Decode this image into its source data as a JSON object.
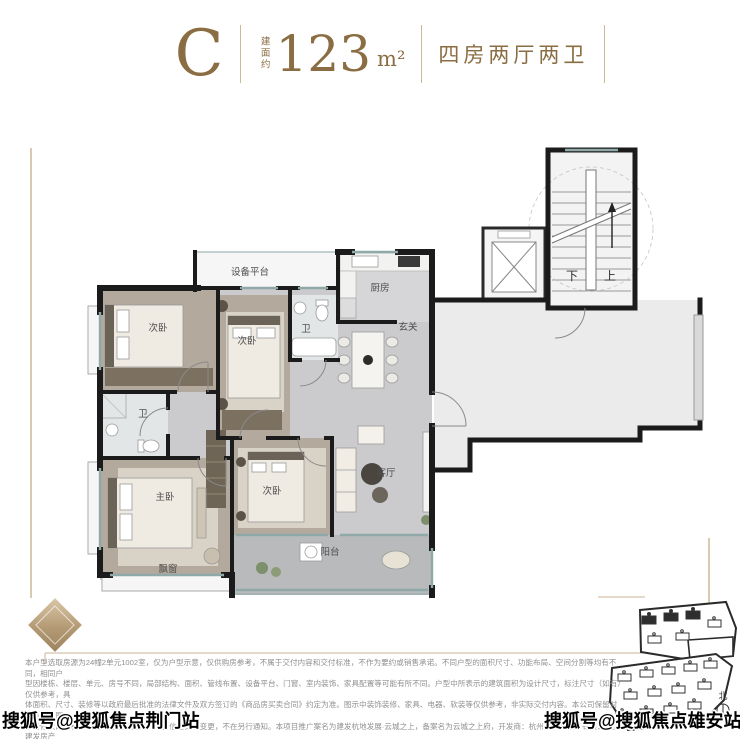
{
  "header": {
    "plan_letter": "C",
    "area_prefix": "建面约",
    "area_value": "123",
    "area_unit": "m²",
    "layout_desc": "四房两厅两卫"
  },
  "colors": {
    "accent": "#8a6d42",
    "divider": "#cdb897",
    "wall": "#1b1b1b",
    "frame_line": "#c9b394",
    "window": "#8fa9a8"
  },
  "floorplan": {
    "labels": {
      "equipment_platform": "设备平台",
      "kitchen": "厨房",
      "entry": "玄关",
      "living_room": "客厅",
      "master_bedroom": "主卧",
      "bedroom": "次卧",
      "bath": "卫",
      "balcony": "阳台",
      "bay_window": "飘窗",
      "stairs_down": "下",
      "stairs_up": "上"
    }
  },
  "siteplan": {
    "north_label": "北"
  },
  "watermarks": {
    "bottom_left": "搜狐号@搜狐焦点荆门站",
    "bottom_right": "搜狐号@搜狐焦点雄安站"
  },
  "disclaimer": {
    "lines": [
      "本户型选取房源为24幢2单元1002室，仅为户型示意，仅供购房参考，不属于交付内容和交付标准，不作为要约或销售承诺。不同户型的面积尺寸、功能布局、空间分割等均有不同，相同户",
      "型因楼栋、楼层、单元、房号不同，局部结构、面积、管线布置、设备平台、门窗、室内装饰、家具配置等可能有所不同。户型中所表示的建筑面积为设计尺寸，标注尺寸（如有）仅供参考，具",
      "体面积、尺寸、装修等以政府最后批准的法律文件及双方签订的《商品房买卖合同》约定为准。图示中装饰装修、家具、电器、软装等仅供参考，非实际交付内容。本公司保留对户型示意图",
      "进行修改的权利，敬请留意最新资料。广告信息如有变更，不在另行通知。本项目推广案名为建发杭地发展·云城之上，备案名为云城之上府，开发商：杭州高呈房地产有限公司。建发房产",
      "全国服务热线400-846-3636；本资料发布日期2024年6月，有效期1个月。"
    ]
  }
}
